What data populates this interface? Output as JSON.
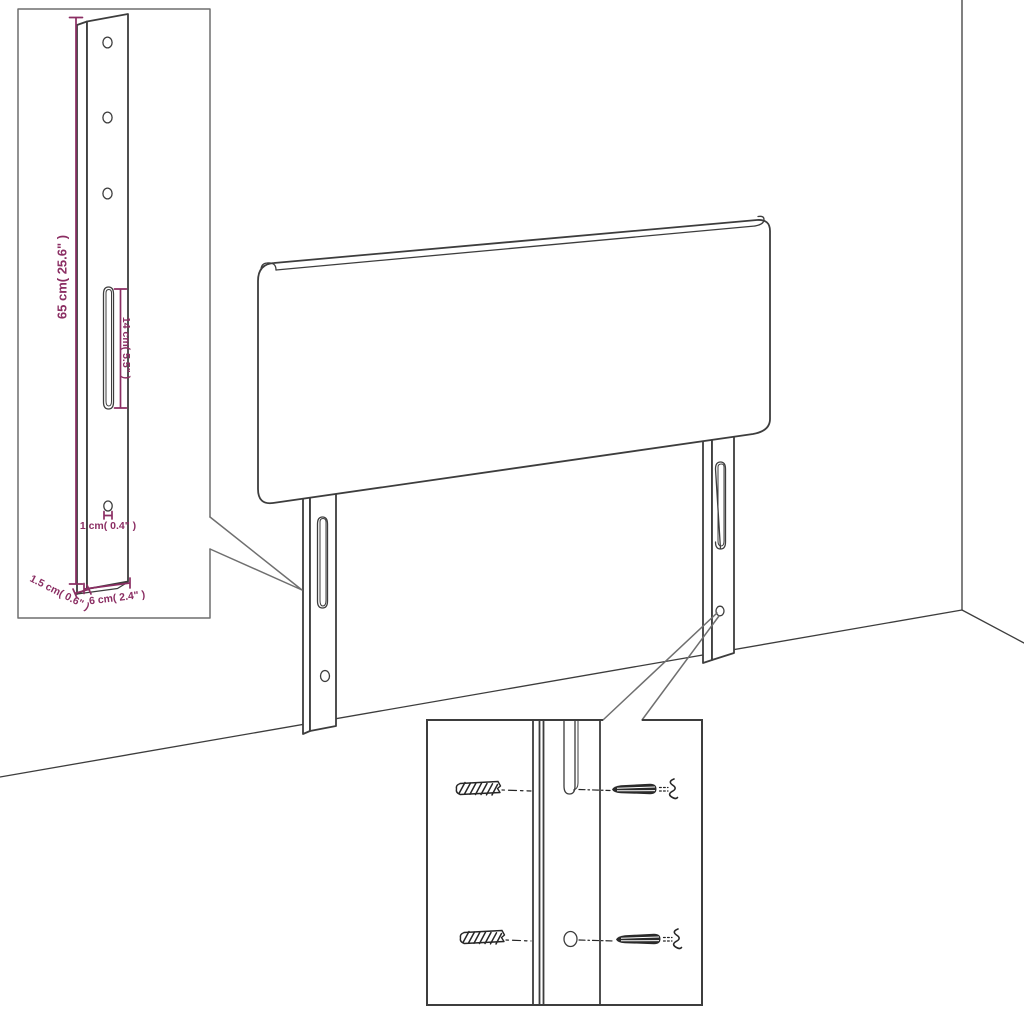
{
  "diagram_title": "headboard-with-legs-dimension-diagram",
  "colors": {
    "background": "#ffffff",
    "drawing_line": "#3d3d3d",
    "inset_border": "#6f6f6f",
    "dimension": "#8b2e63",
    "hardware": "#262626"
  },
  "main_view": {
    "leg_count": 2,
    "slots_per_leg": 1,
    "holes_per_leg": 1
  },
  "leg_detail_inset": {
    "height_label": "65 cm( 25.6\" )",
    "slot_label": "14 cm( 5.5\" )",
    "hole_label": "1 cm( 0.4\" )",
    "thickness_label": "1.5 cm( 0.6\" )",
    "width_label": "6 cm( 2.4\" )",
    "hole_count": 3
  },
  "hardware_inset": {
    "wall_plug_count": 2,
    "screw_count": 2
  }
}
